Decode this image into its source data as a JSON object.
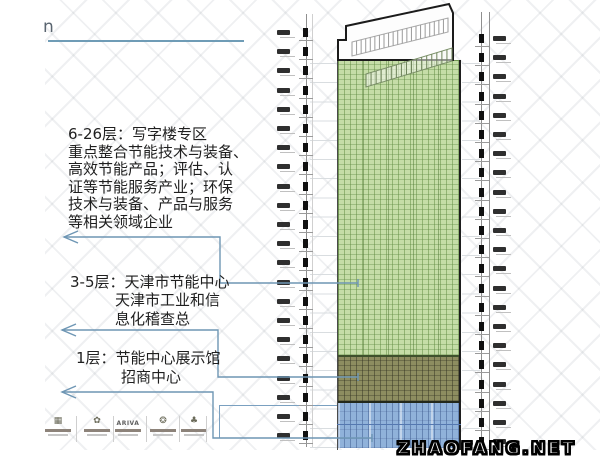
{
  "header": {
    "fragment": "n",
    "rule_color": "#6f9cb6"
  },
  "annotations": {
    "block1": "6-26层：写字楼专区\n重点整合节能技术与装备、\n高效节能产品；评估、认\n证等节能服务产业；环保\n技术与装备、产品与服务\n等相关领域企业",
    "block2": "3-5层：天津市节能中心\n　　　天津市工业和信\n　　　息化稽查总",
    "block3": "1层：节能中心展示馆\n　　　招商中心"
  },
  "building": {
    "sections": [
      {
        "name": "office-zone",
        "floors": "6-26层",
        "color": "#c5dda7"
      },
      {
        "name": "energy-center-zone",
        "floors": "3-5层",
        "color": "#8d8d60"
      },
      {
        "name": "exhibition-hall-zone",
        "floors": "1层",
        "color": "#90b2da"
      }
    ],
    "outline_color": "#1e1e1e"
  },
  "connectors": {
    "color": "#6e96b4"
  },
  "dimension_strips": {
    "left": {
      "tick_count": 22
    },
    "right": {
      "tick_count": 22
    }
  },
  "logos": {
    "items": [
      {
        "icon": "building-icon",
        "glyph": "▦"
      },
      {
        "icon": "flower-icon",
        "glyph": "✿"
      },
      {
        "icon": "ariva-logo",
        "label": "ARIVA"
      },
      {
        "icon": "gear-icon",
        "glyph": "❂"
      },
      {
        "icon": "tree-icon",
        "glyph": "♣"
      }
    ]
  },
  "watermark": {
    "text": "ZHAOFANG.NET"
  }
}
